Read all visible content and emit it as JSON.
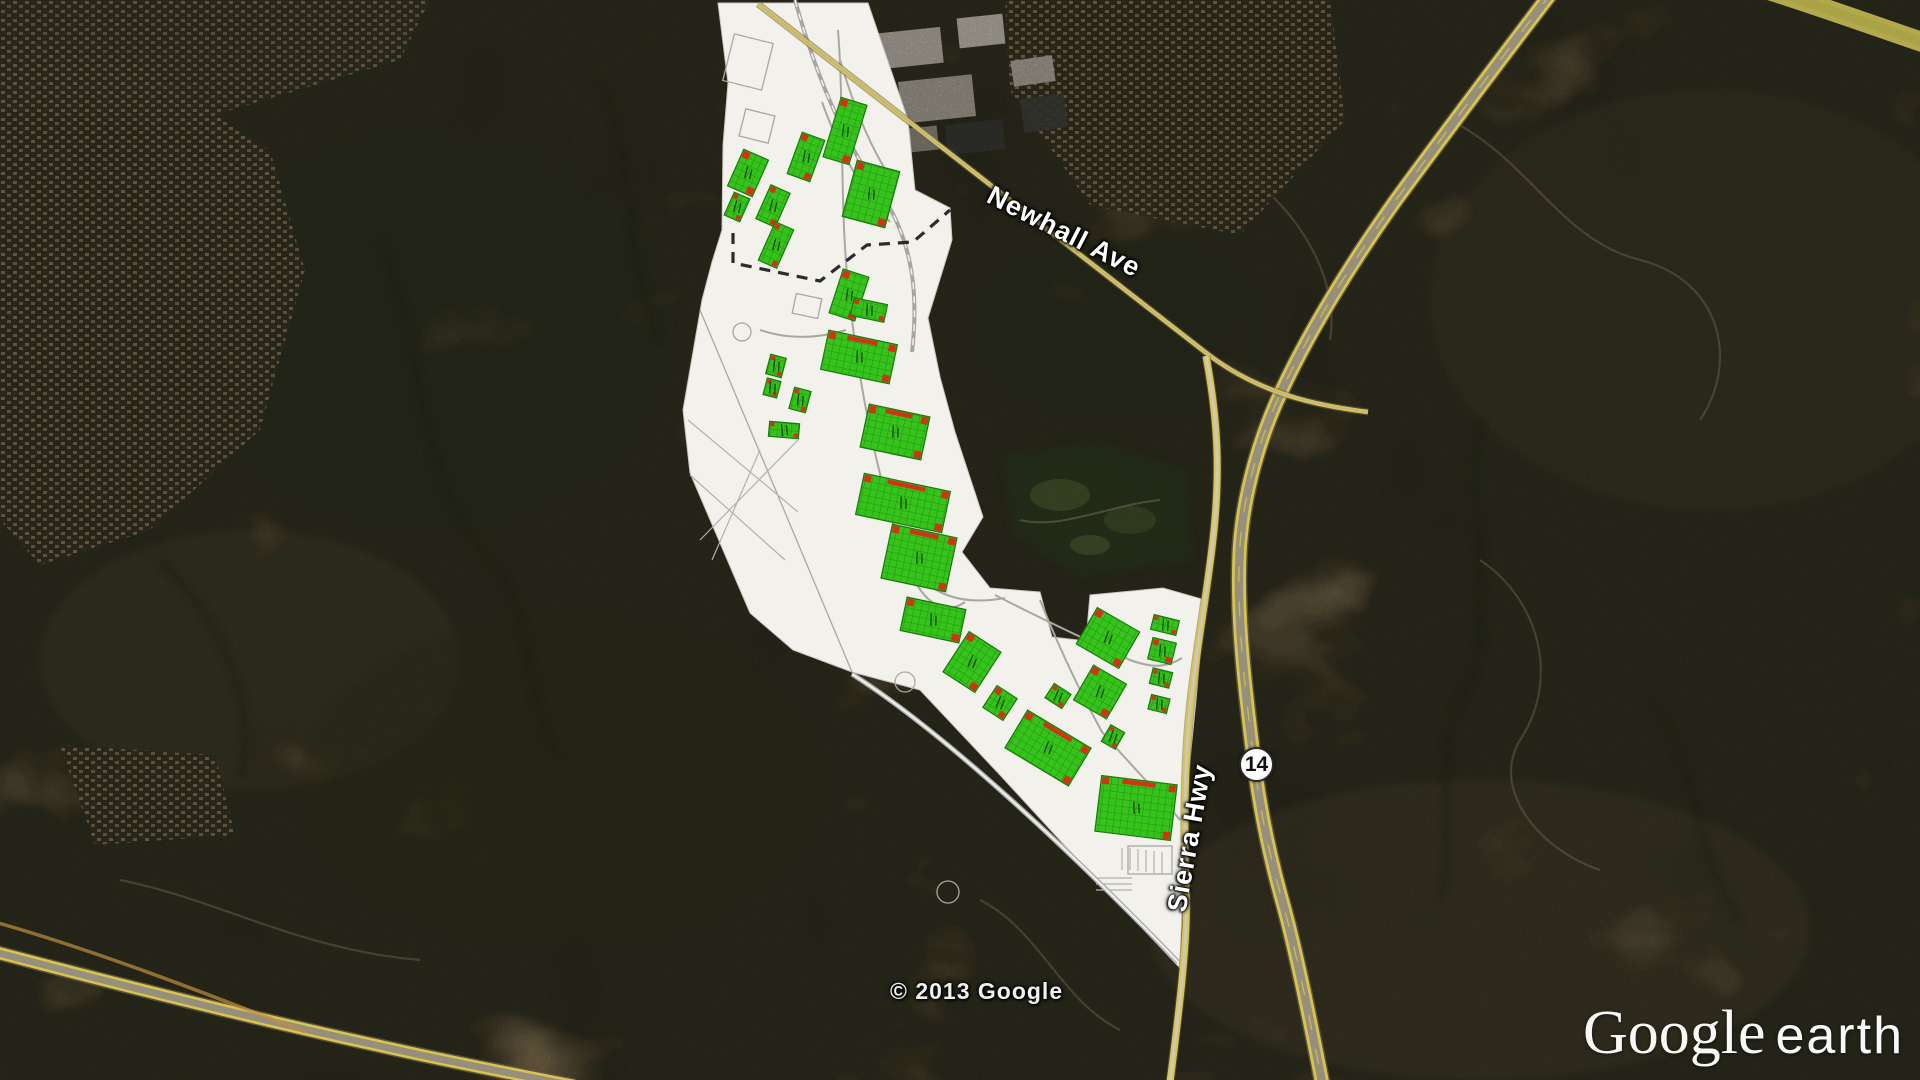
{
  "application": "Google Earth",
  "map": {
    "labels": {
      "newhall_ave": "Newhall Ave",
      "sierra_hwy": "Sierra Hwy",
      "highway_shield": "14",
      "copyright": "© 2013 Google",
      "logo_primary": "Google",
      "logo_secondary": "earth"
    },
    "colors": {
      "building_green": "#35c31c",
      "building_grid": "#1f8c10",
      "building_outline": "#157a08",
      "dock_red": "#d03415",
      "road_yellow": "#d9c44e",
      "plan_white": "#f2f1ec",
      "terrain_base": "#4a3d2c"
    },
    "site_plan": {
      "description": "Industrial park site plan overlay with green building footprints and red loading dock marks",
      "buildings": [
        {
          "x": 845,
          "y": 131,
          "w": 27,
          "h": 62,
          "r": 17
        },
        {
          "x": 806,
          "y": 157,
          "w": 24,
          "h": 44,
          "r": 20
        },
        {
          "x": 748,
          "y": 173,
          "w": 27,
          "h": 40,
          "r": 24
        },
        {
          "x": 737,
          "y": 207,
          "w": 17,
          "h": 25,
          "r": 24
        },
        {
          "x": 773,
          "y": 206,
          "w": 21,
          "h": 37,
          "r": 24
        },
        {
          "x": 776,
          "y": 245,
          "w": 20,
          "h": 42,
          "r": 24
        },
        {
          "x": 871,
          "y": 194,
          "w": 44,
          "h": 58,
          "r": 15
        },
        {
          "x": 849,
          "y": 295,
          "w": 27,
          "h": 46,
          "r": 18
        },
        {
          "x": 869,
          "y": 310,
          "w": 34,
          "h": 18,
          "r": 12
        },
        {
          "x": 776,
          "y": 366,
          "w": 16,
          "h": 20,
          "r": 15
        },
        {
          "x": 772,
          "y": 388,
          "w": 14,
          "h": 17,
          "r": 15
        },
        {
          "x": 800,
          "y": 400,
          "w": 17,
          "h": 22,
          "r": 15
        },
        {
          "x": 784,
          "y": 430,
          "w": 30,
          "h": 15,
          "r": 5
        },
        {
          "x": 859,
          "y": 357,
          "w": 70,
          "h": 40,
          "r": 12
        },
        {
          "x": 895,
          "y": 432,
          "w": 62,
          "h": 44,
          "r": 12
        },
        {
          "x": 903,
          "y": 503,
          "w": 88,
          "h": 42,
          "r": 12
        },
        {
          "x": 919,
          "y": 558,
          "w": 66,
          "h": 55,
          "r": 12
        },
        {
          "x": 933,
          "y": 620,
          "w": 60,
          "h": 34,
          "r": 12
        },
        {
          "x": 972,
          "y": 662,
          "w": 38,
          "h": 48,
          "r": 33
        },
        {
          "x": 1000,
          "y": 703,
          "w": 24,
          "h": 26,
          "r": 33
        },
        {
          "x": 1058,
          "y": 696,
          "w": 20,
          "h": 17,
          "r": 33
        },
        {
          "x": 1108,
          "y": 638,
          "w": 49,
          "h": 42,
          "r": 30
        },
        {
          "x": 1100,
          "y": 692,
          "w": 38,
          "h": 40,
          "r": 30
        },
        {
          "x": 1165,
          "y": 625,
          "w": 26,
          "h": 15,
          "r": 14
        },
        {
          "x": 1162,
          "y": 651,
          "w": 24,
          "h": 22,
          "r": 14
        },
        {
          "x": 1161,
          "y": 678,
          "w": 20,
          "h": 16,
          "r": 14
        },
        {
          "x": 1159,
          "y": 704,
          "w": 19,
          "h": 15,
          "r": 14
        },
        {
          "x": 1113,
          "y": 737,
          "w": 16,
          "h": 19,
          "r": 30
        },
        {
          "x": 1048,
          "y": 748,
          "w": 74,
          "h": 44,
          "r": 31
        },
        {
          "x": 1136,
          "y": 808,
          "w": 76,
          "h": 56,
          "r": 7
        }
      ]
    }
  }
}
